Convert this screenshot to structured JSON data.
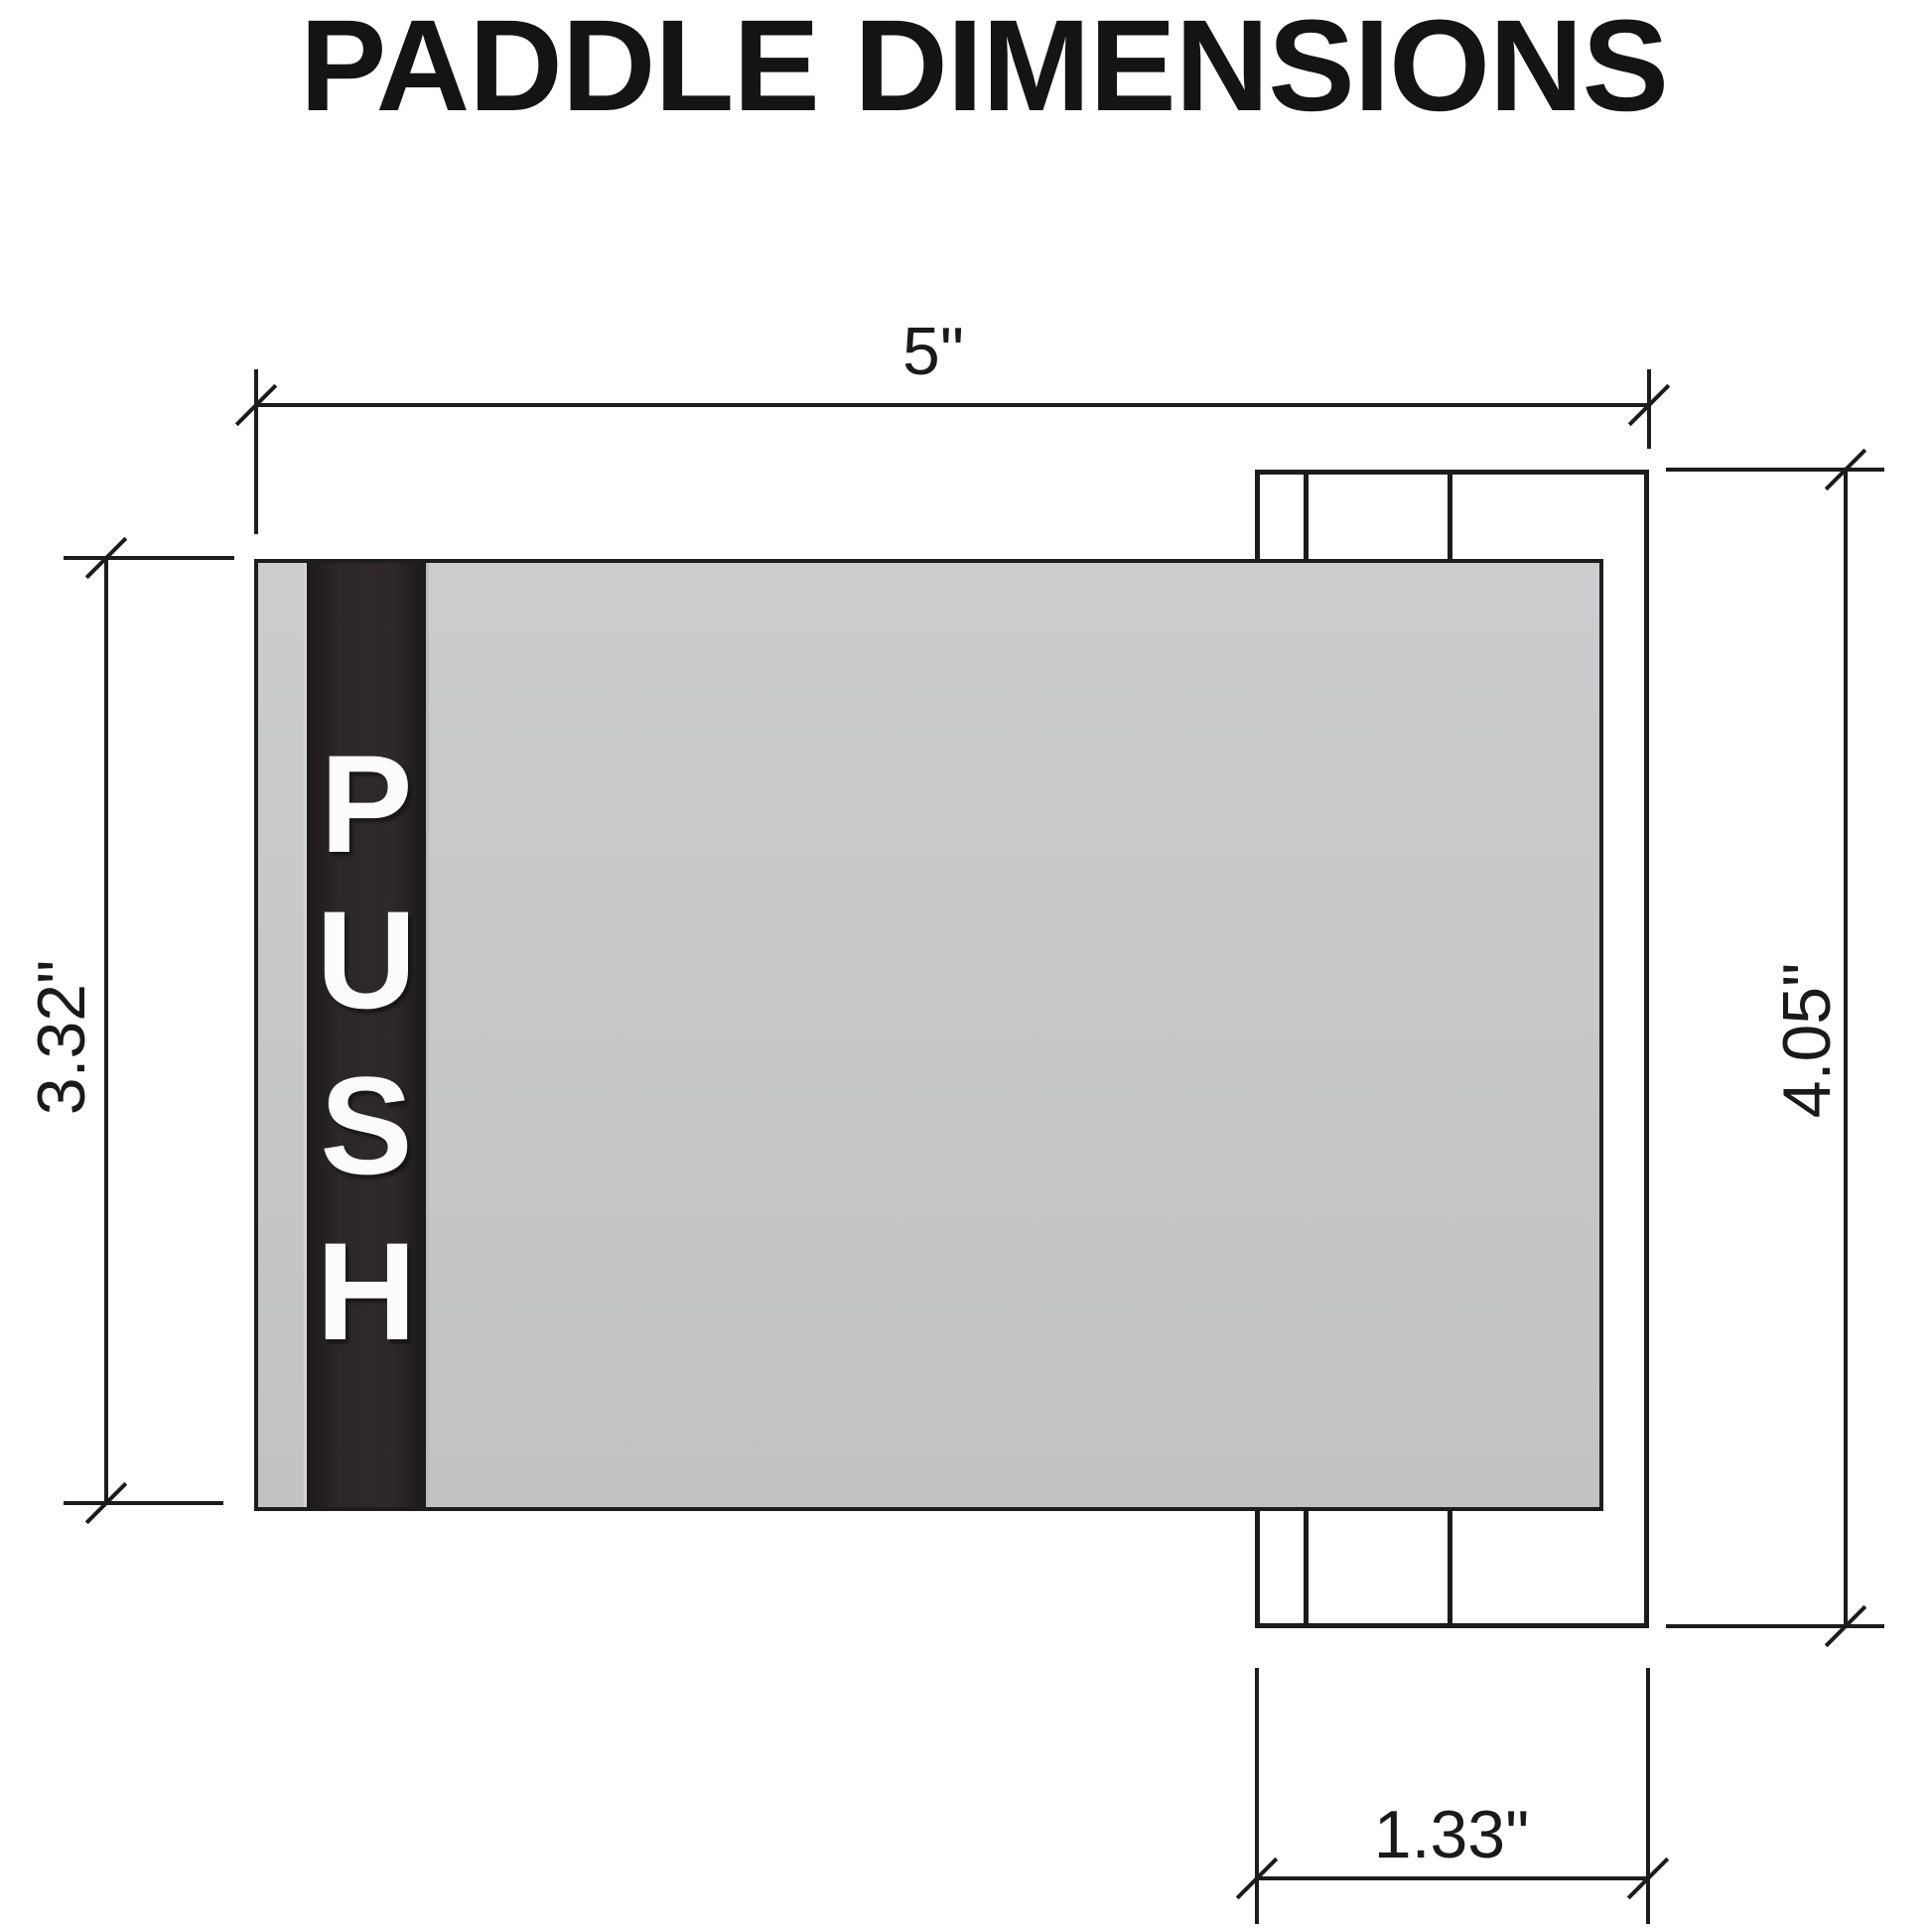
{
  "title": "PADDLE DIMENSIONS",
  "paddle": {
    "label": "PUSH",
    "letters": [
      "P",
      "U",
      "S",
      "H"
    ]
  },
  "dimensions": {
    "overall_width": "5\"",
    "paddle_height": "3.32\"",
    "bracket_height": "4.05\"",
    "bracket_width": "1.33\""
  },
  "colors": {
    "background": "#ffffff",
    "line": "#1c1c1c",
    "paddle_gray": "#c7c8ca",
    "push_strip": "#2c2728",
    "push_text": "#fbfbfb",
    "title_text": "#141414"
  }
}
